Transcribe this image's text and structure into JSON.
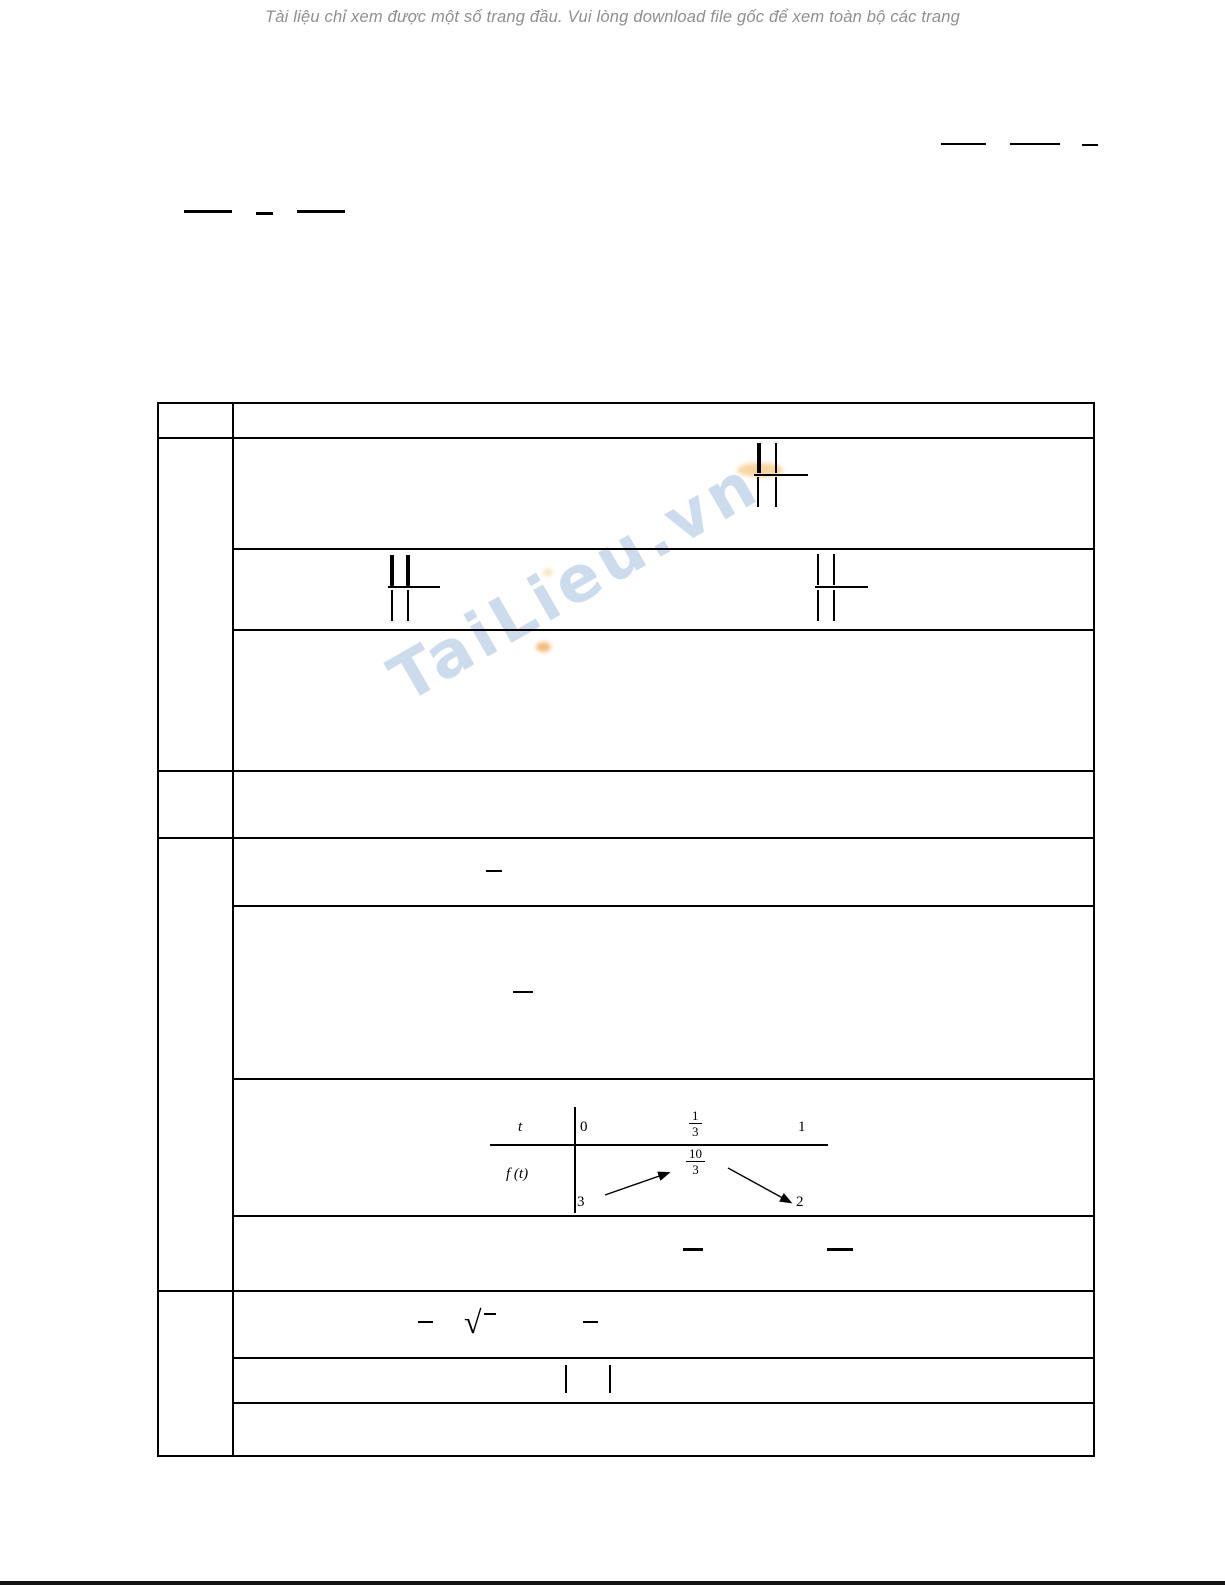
{
  "notice": {
    "text": "Tài liệu chỉ xem được một số trang đầu. Vui lòng download file gốc để xem toàn bộ các trang"
  },
  "watermark": {
    "text": "TaiLieu.vn",
    "color": "#bdd1e8"
  },
  "symbols": {
    "radical": "√"
  },
  "variation_table": {
    "var_label": "t",
    "func_label": "f (t)",
    "x_start": "0",
    "x_mid_num": "1",
    "x_mid_den": "3",
    "x_end": "1",
    "f_start": "3",
    "f_max_num": "10",
    "f_max_den": "3",
    "f_end": "2"
  },
  "marks": {
    "hbars": [
      [
        941,
        143,
        45,
        2
      ],
      [
        1010,
        143,
        50,
        2
      ],
      [
        1082,
        144,
        16,
        2
      ],
      [
        184,
        210,
        48,
        3
      ],
      [
        256,
        212,
        17,
        3
      ],
      [
        297,
        210,
        48,
        3
      ],
      [
        754,
        474,
        54,
        2
      ],
      [
        388,
        586,
        52,
        2
      ],
      [
        815,
        586,
        53,
        2
      ],
      [
        486,
        870,
        16,
        2
      ],
      [
        513,
        991,
        20,
        2
      ],
      [
        683,
        1248,
        20,
        3
      ],
      [
        827,
        1248,
        26,
        3
      ],
      [
        418,
        1321,
        15,
        2
      ],
      [
        583,
        1321,
        15,
        2
      ],
      [
        484,
        1313,
        12,
        2
      ]
    ],
    "vbars": [
      [
        757,
        443,
        4,
        30
      ],
      [
        775,
        443,
        2,
        30
      ],
      [
        757,
        477,
        2,
        30
      ],
      [
        775,
        477,
        2,
        30
      ],
      [
        390,
        555,
        4,
        31
      ],
      [
        406,
        555,
        4,
        31
      ],
      [
        391,
        590,
        2,
        31
      ],
      [
        407,
        590,
        2,
        31
      ],
      [
        817,
        554,
        2,
        31
      ],
      [
        833,
        554,
        2,
        31
      ],
      [
        817,
        590,
        2,
        31
      ],
      [
        833,
        590,
        2,
        31
      ],
      [
        565,
        1365,
        2,
        28
      ],
      [
        609,
        1365,
        2,
        28
      ]
    ],
    "blobs": [
      [
        737,
        463,
        46,
        14,
        0
      ],
      [
        536,
        642,
        15,
        10,
        1
      ],
      [
        543,
        569,
        10,
        7,
        2
      ]
    ]
  },
  "accents": {
    "line_color": "#000000",
    "notice_color": "#8f8f8f",
    "blob_colors": [
      "#f6c87f",
      "#eda64b",
      "#f3d9a0"
    ],
    "bottom_bar_color": "#141414"
  }
}
